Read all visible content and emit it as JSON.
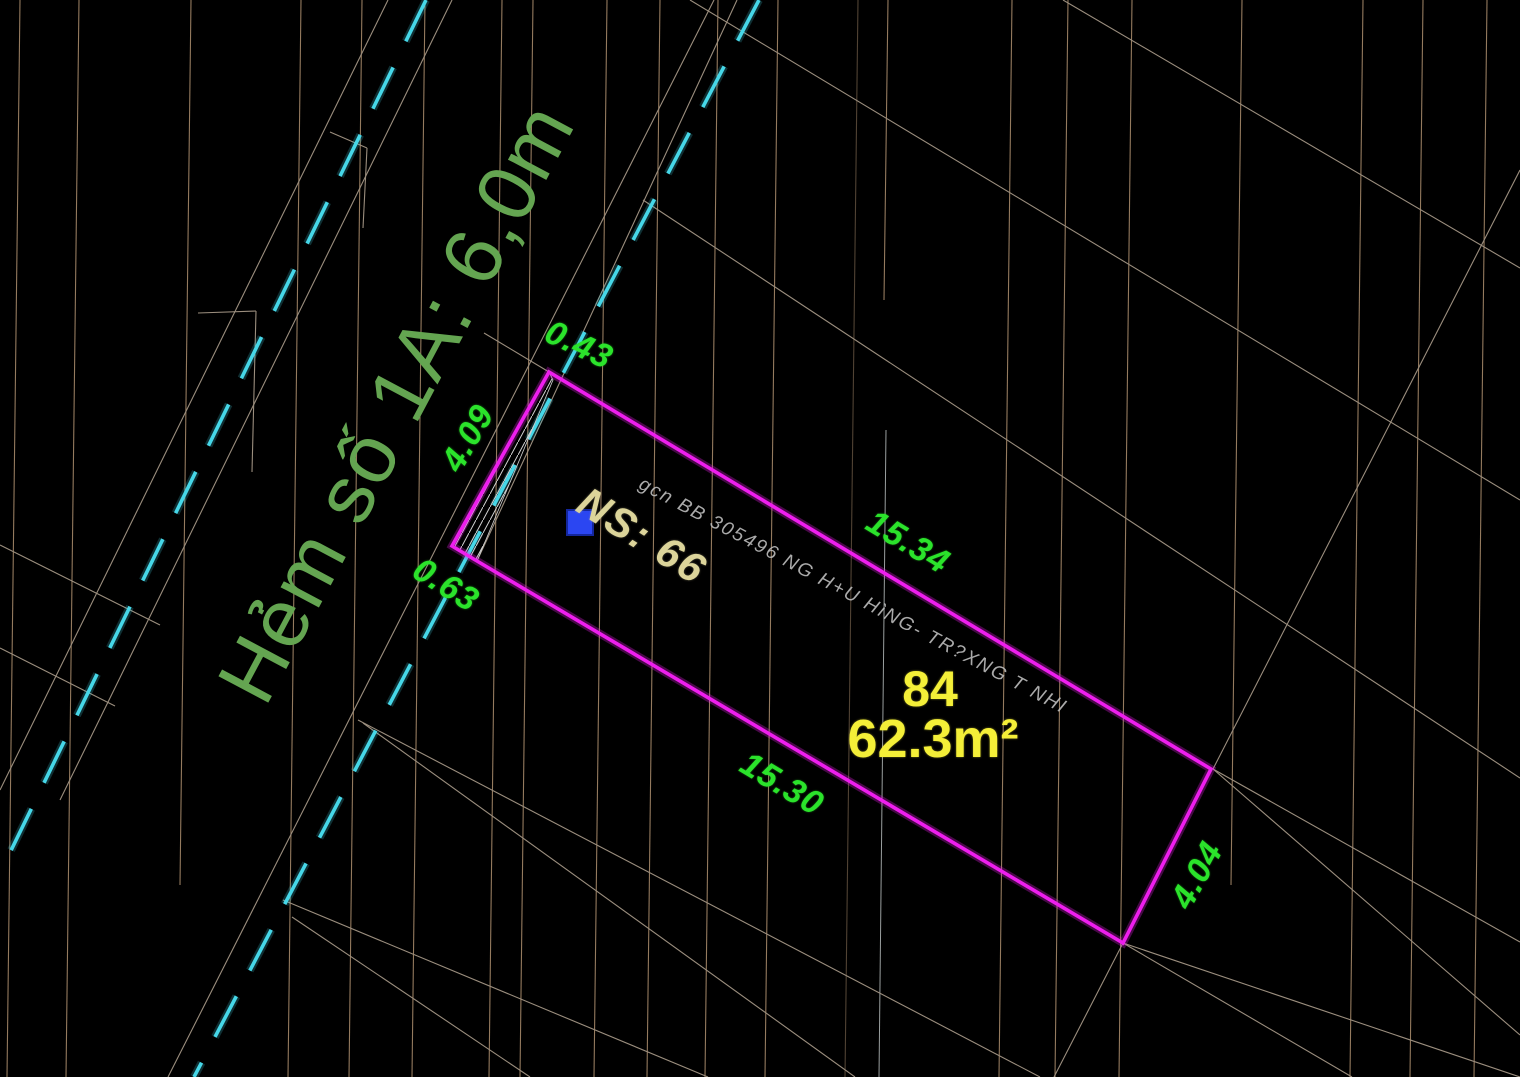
{
  "street": {
    "label": "Hẻm số 1A: 6,0m"
  },
  "parcel": {
    "number": "84",
    "area": "62.3m²",
    "house_number": "NS: 66",
    "deed_note": "gcn BB 305496 NG H+U HìNG- TR?XNG T NHI"
  },
  "dimensions": {
    "top_edge": "15.34",
    "bottom_edge": "15.30",
    "right_edge": "4.04",
    "left_edge": "4.09",
    "frontage_top": "0.43",
    "frontage_bottom": "0.63"
  },
  "colors": {
    "background": "#000000",
    "parcel_outline": "#ee1eee",
    "road_dashed": "#46d7e8",
    "dimension_text": "#2be32b",
    "street_text": "#64a551",
    "parcel_text": "#f4ef38",
    "house_number_text": "#dcd49a",
    "deed_note_text": "#bdbdbd",
    "grid_line": "#a6896a",
    "boundary_line": "#9b8e7e",
    "marker_square": "#2b46f2"
  }
}
